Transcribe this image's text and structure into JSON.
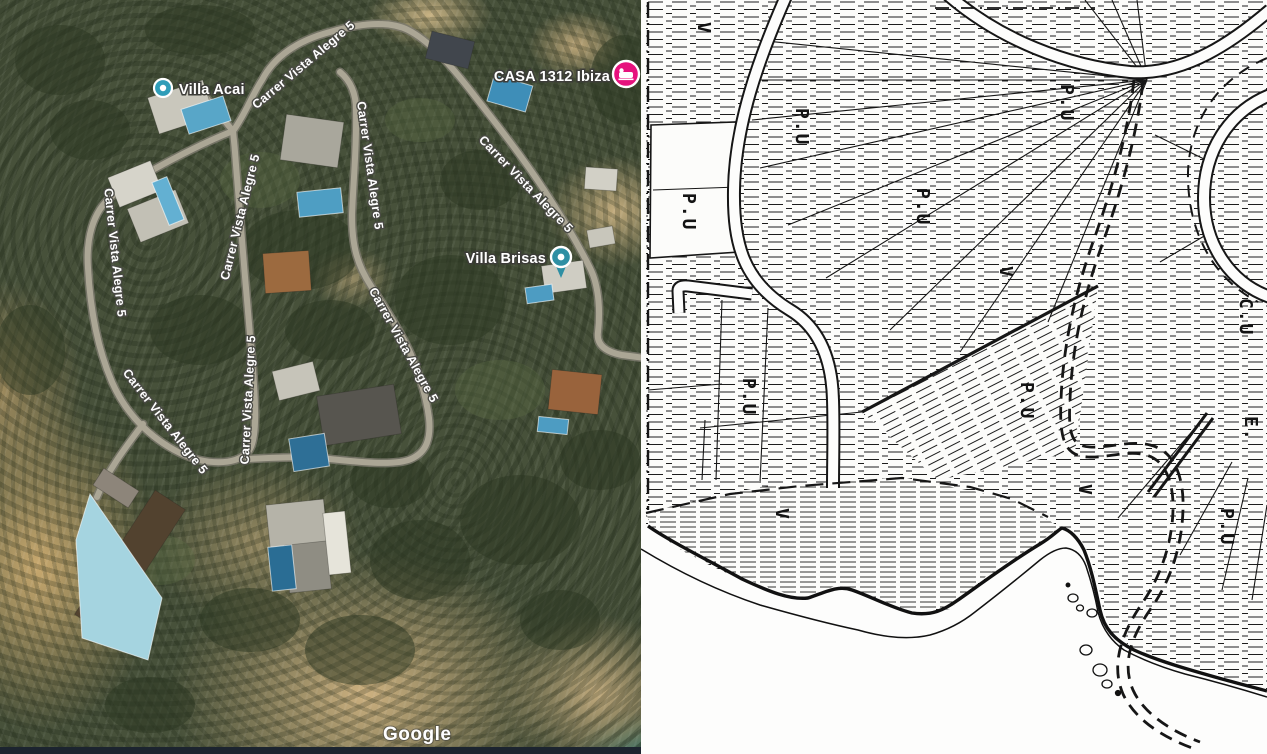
{
  "window": {
    "width_px": 1267,
    "height_px": 754
  },
  "left_map": {
    "type": "satellite",
    "street_name": "Carrer Vista Alegre 5",
    "places": [
      {
        "name": "Villa Acai",
        "marker": "place-dot"
      },
      {
        "name": "CASA 1312 Ibiza",
        "marker": "lodging-pin"
      },
      {
        "name": "Villa Brisas",
        "marker": "place-pin"
      }
    ],
    "attribution": "Google"
  },
  "right_map": {
    "type": "cadastral-plan",
    "zone_labels": [
      "V",
      "P.U",
      "P.U",
      "P.U",
      "P.U",
      "V",
      "P.U",
      "P.U",
      "C.U",
      "E.",
      "V",
      "V",
      "P.U"
    ]
  },
  "colors": {
    "marker_teal": "#2f9db8",
    "marker_pin_teal": "#2e8fa3",
    "marker_pink": "#e6127d",
    "pool_blue": "#4f9fc4",
    "road_gray": "#aba695",
    "plan_ink": "#161616",
    "attribution_strip": "#1c242f"
  }
}
